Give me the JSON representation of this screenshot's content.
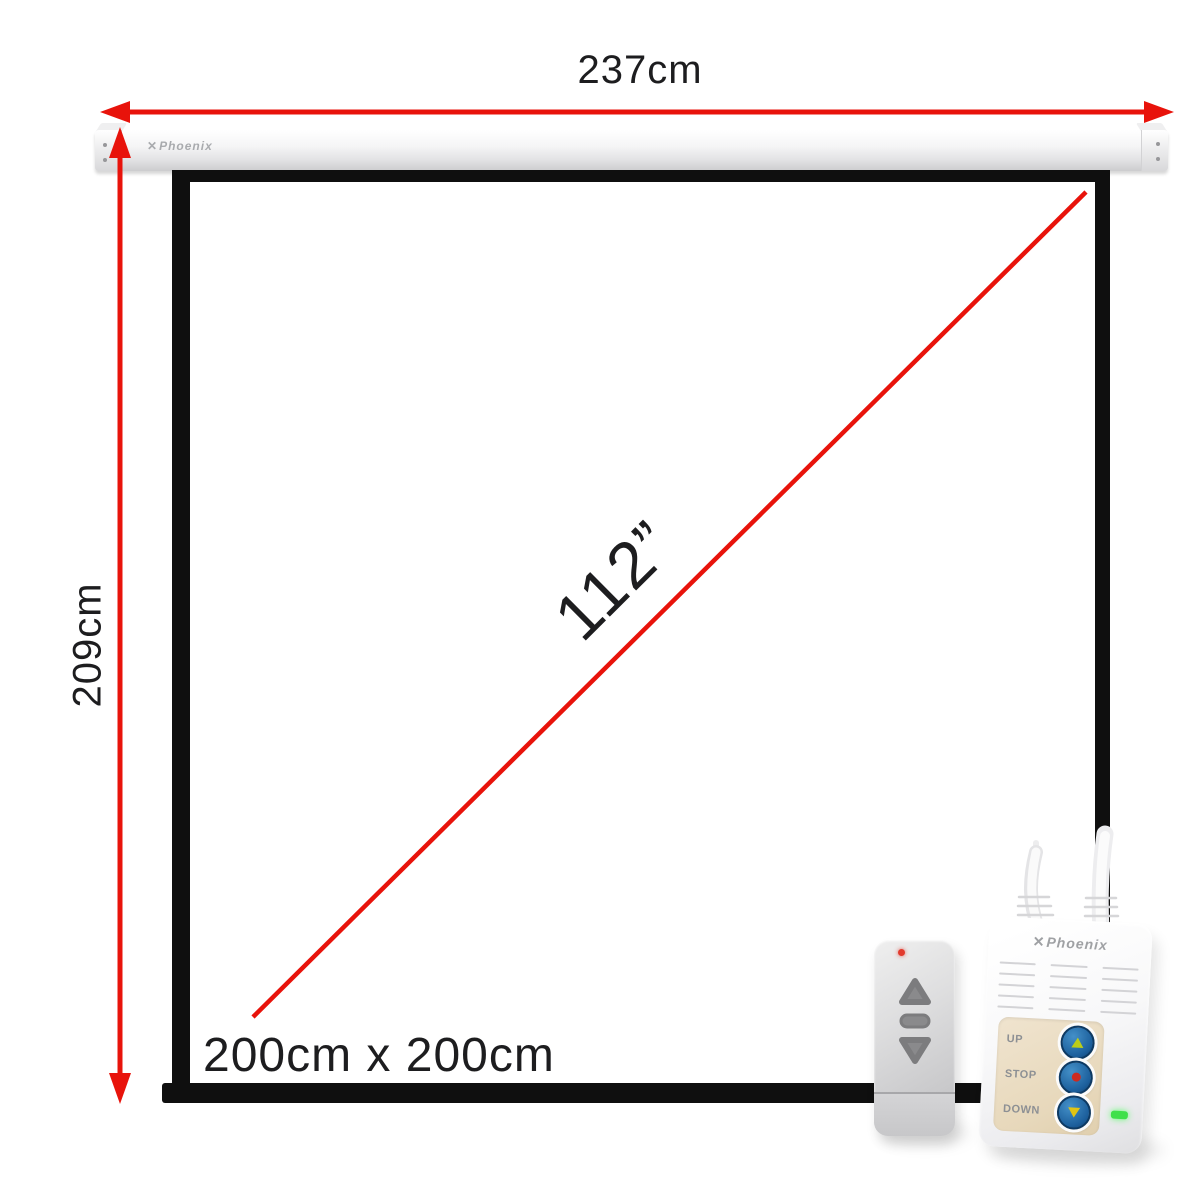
{
  "labels": {
    "width": "237cm",
    "height": "209cm",
    "diagonal": "112”",
    "size": "200cm x 200cm"
  },
  "casing": {
    "brand": "Phoenix",
    "logo_icon": "phoenix-x-icon"
  },
  "remote": {
    "led": "red-indicator-led",
    "buttons": [
      {
        "icon": "up-triangle"
      },
      {
        "icon": "middle-pill"
      },
      {
        "icon": "down-triangle"
      }
    ]
  },
  "control_unit": {
    "brand": "Phoenix",
    "logo_icon": "phoenix-x-icon",
    "buttons": [
      {
        "label": "UP",
        "icon": "up-arrow"
      },
      {
        "label": "STOP",
        "icon": "stop-dot"
      },
      {
        "label": "DOWN",
        "icon": "down-arrow"
      }
    ],
    "status_led": "green-power-led"
  },
  "colors": {
    "accent_red": "#e8130b",
    "frame_black": "#0f0f0f",
    "keypad_beige": "#e7d8bb",
    "button_blue": "#1c5f9c",
    "glyph_yellow": "#d3cc16",
    "stop_red": "#cc2a20",
    "led_green": "#3fe04a"
  }
}
